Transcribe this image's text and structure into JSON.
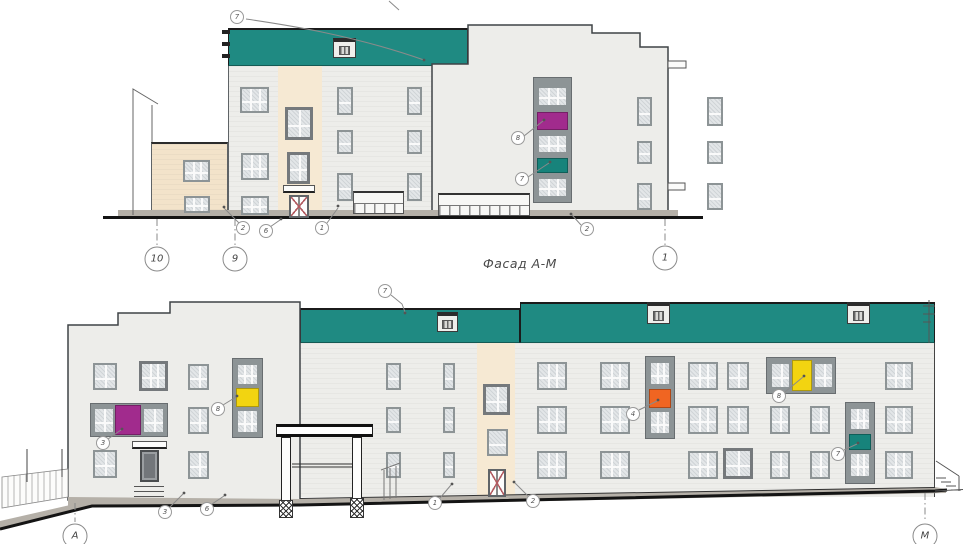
{
  "drawing": {
    "title": "Фасад А-М"
  },
  "axis_markers": {
    "top": [
      {
        "label": "10"
      },
      {
        "label": "9"
      },
      {
        "label": "1"
      }
    ],
    "bottom": [
      {
        "label": "А"
      },
      {
        "label": "М"
      }
    ]
  },
  "callouts": {
    "top_roof": "7",
    "top_stair_upper": "8",
    "top_stair_lower": "7",
    "top_ground_left": "2",
    "top_ground_mid": "6",
    "top_ground_right": "1",
    "top_ground_far_right": "2",
    "bottom_roof": "7",
    "bottom_magenta": "3",
    "bottom_yellow_left": "8",
    "bottom_orange": "4",
    "bottom_yellow_right": "8",
    "bottom_teal": "7",
    "bottom_ground_1": "3",
    "bottom_ground_2": "6",
    "bottom_ground_3": "1",
    "bottom_ground_4": "2"
  },
  "colors": {
    "roof": "#1f8a82",
    "magenta": "#a12b8d",
    "teal_panel": "#17837b",
    "yellow": "#f2d411",
    "orange": "#f06522",
    "wall": "#ededea",
    "beige": "#f3e3ca",
    "beige_light": "#f6e9d3",
    "frame": "#8d9496",
    "glass": "#e3e6e8",
    "ground": "#b5b0a8"
  }
}
